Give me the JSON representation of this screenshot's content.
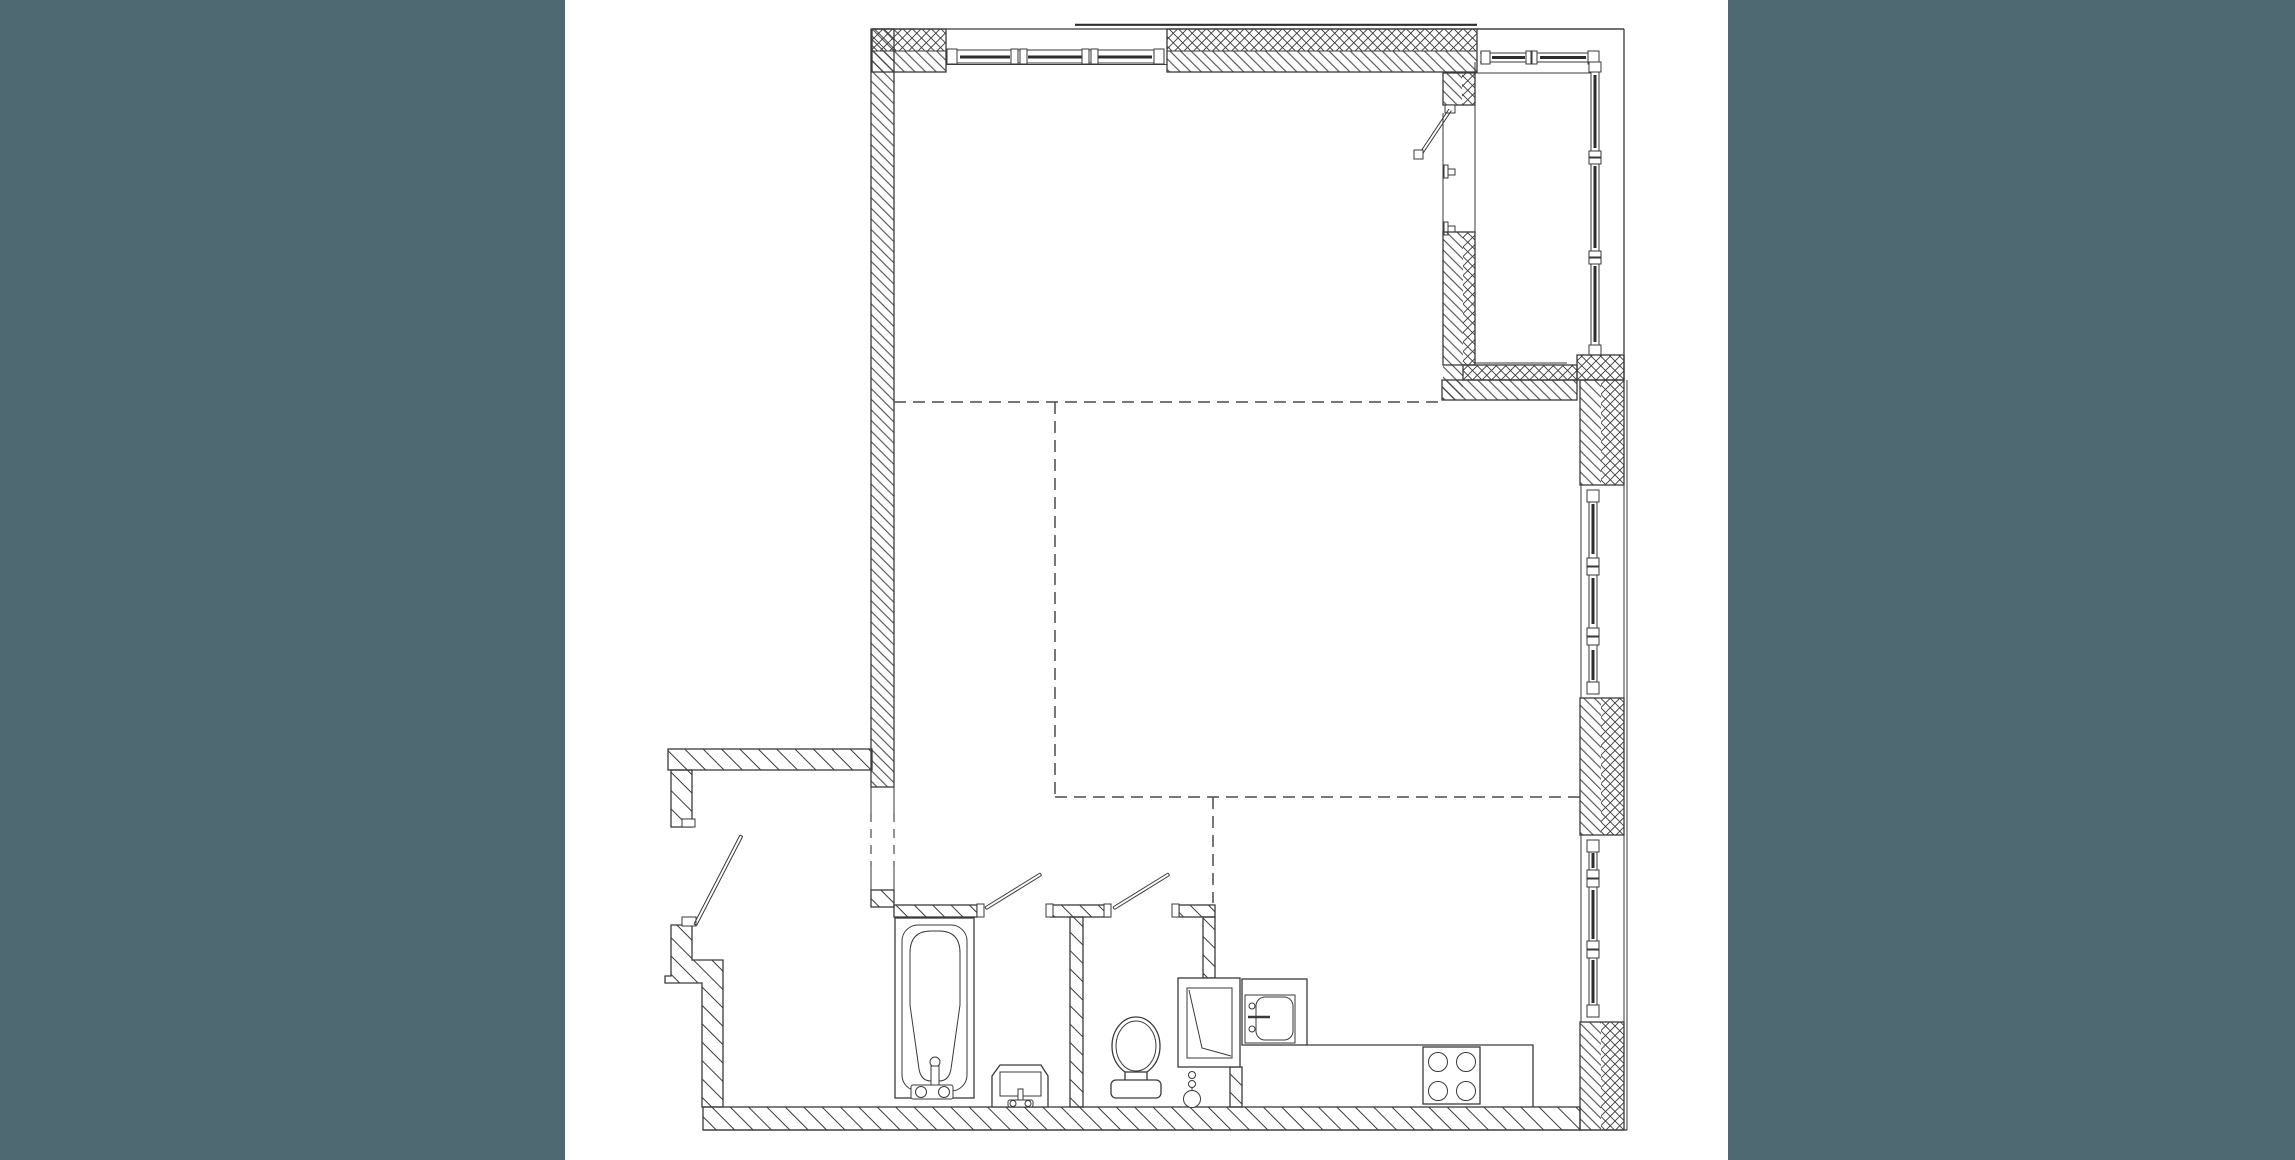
{
  "canvas": {
    "width": 2295,
    "height": 1160
  },
  "colors": {
    "background": "#ffffff",
    "side_panels": "#4e6972",
    "line": "#3a3a3a",
    "dashed_zone_line": "#4a4a4a"
  },
  "plan": {
    "kind": "black-and-white architectural apartment floor plan linework",
    "zones": [
      "living-area",
      "sleeping-zone",
      "kitchen-zone",
      "entrance-hall",
      "bathroom",
      "wc",
      "glazed-balcony"
    ],
    "fixtures": [
      "bathtub",
      "bathroom-washbasin",
      "toilet",
      "kitchen-sink",
      "kitchen-counter",
      "cooktop-4-burner",
      "ventilation-shaft",
      "floor-drain-riser"
    ],
    "windows": [
      "north-triple-window",
      "east-window-upper",
      "east-window-lower",
      "balcony-glazing"
    ],
    "doors": [
      "entrance-door",
      "bathroom-door",
      "wc-door",
      "balcony-door"
    ],
    "wall_hatches": [
      "dense-diagonal",
      "sparse-diagonal",
      "crosshatch"
    ]
  }
}
